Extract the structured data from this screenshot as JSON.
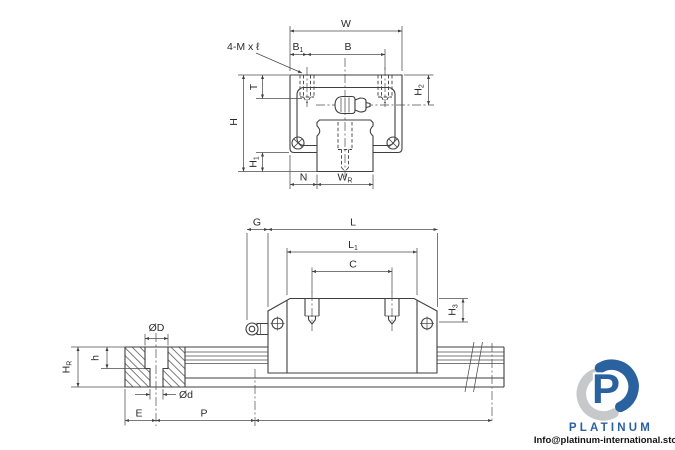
{
  "page": {
    "background": "#ffffff",
    "subject": "linear guideway carriage and rail dimension drawing"
  },
  "front_view": {
    "thread_note": "4-M x ℓ",
    "labels": {
      "w": "W",
      "b": "B",
      "b1_main": "B",
      "b1_sub": "1",
      "t": "T",
      "h": "H",
      "h1_main": "H",
      "h1_sub": "1",
      "h2_main": "H",
      "h2_sub": "2",
      "n": "N",
      "wr_main": "W",
      "wr_sub": "R"
    }
  },
  "side_view": {
    "labels": {
      "g": "G",
      "l": "L",
      "l1_main": "L",
      "l1_sub": "1",
      "c": "C",
      "h3_main": "H",
      "h3_sub": "3",
      "hr_main": "H",
      "hr_sub": "R",
      "h": "h",
      "dia_bore": "ØD",
      "dia_hole": "Ød",
      "e": "E",
      "p": "P"
    }
  },
  "branding": {
    "logo_text": "PLATINUM",
    "email": "Info@platinum-international.store",
    "logo_blue": "#2a62a0",
    "logo_gray": "#c6c8ca"
  }
}
